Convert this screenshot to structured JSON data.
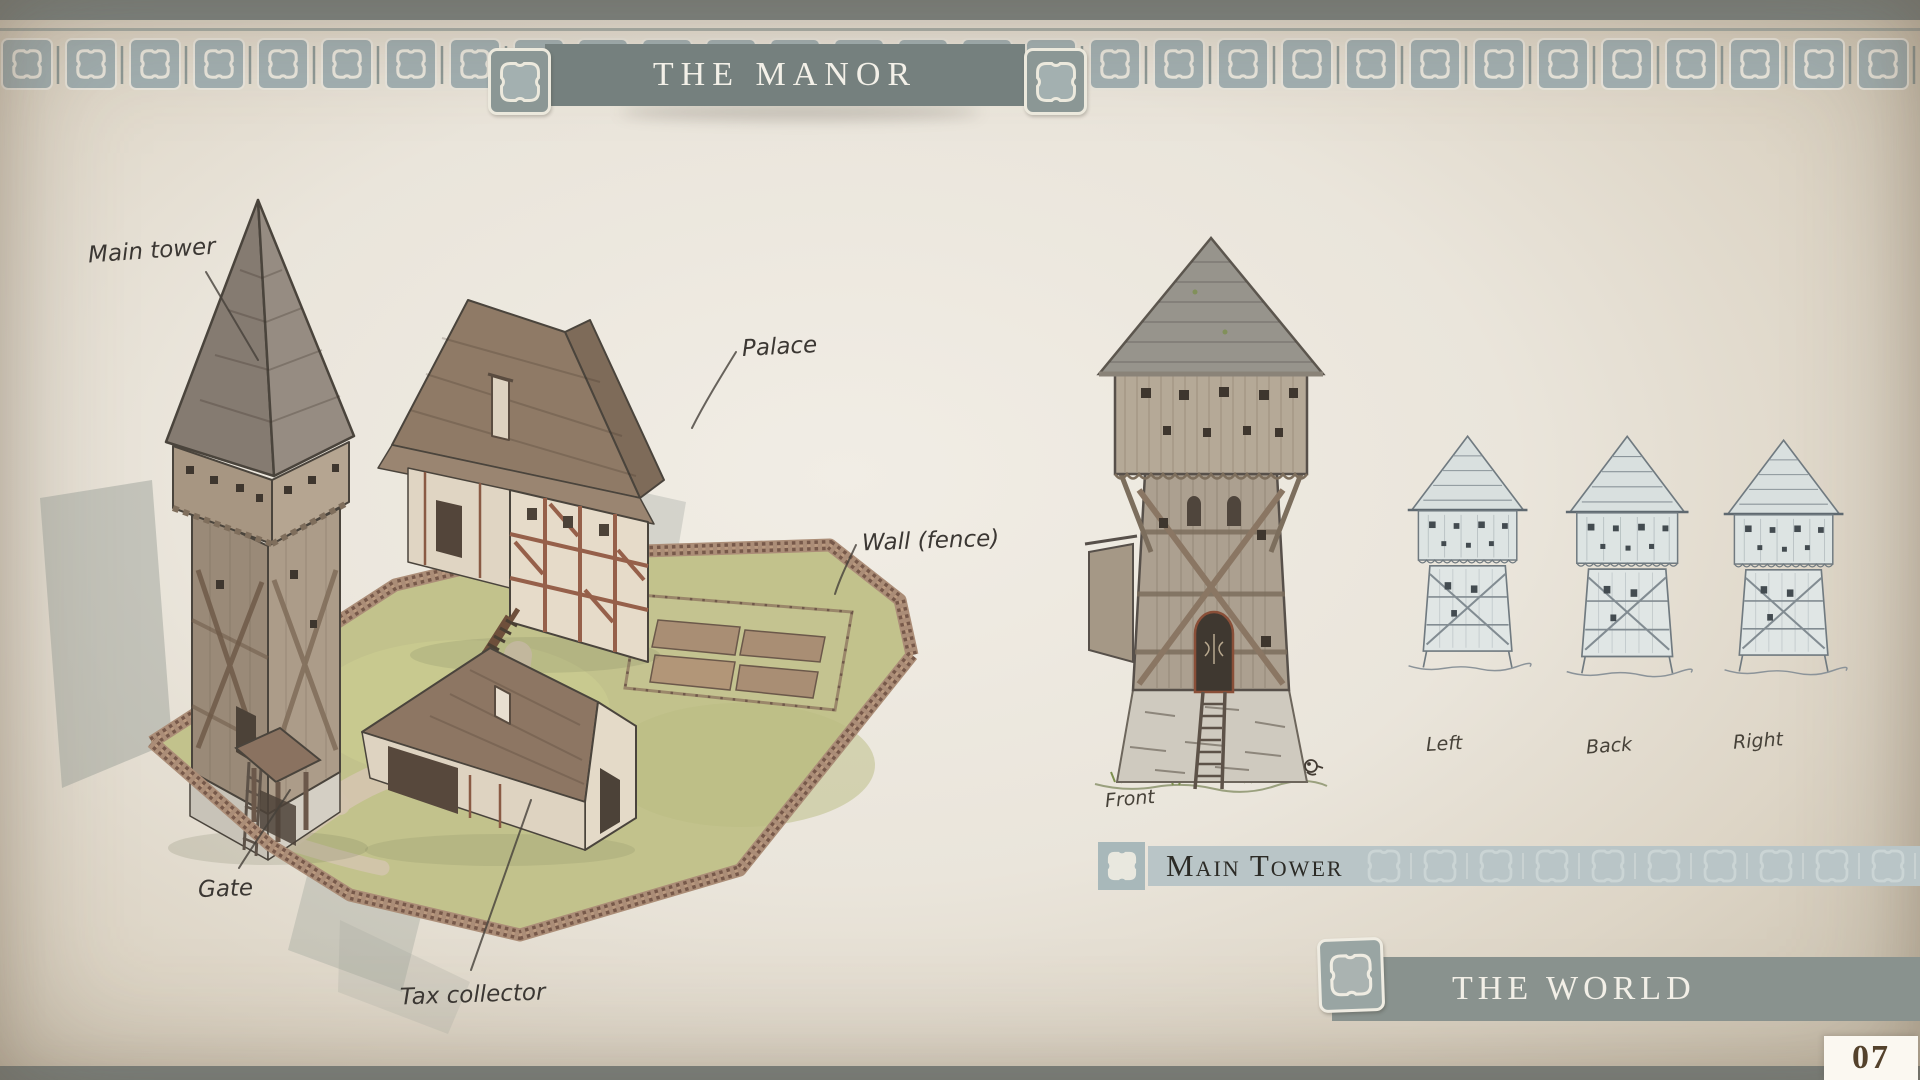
{
  "page": {
    "title": "THE MANOR",
    "number": "07"
  },
  "banners": {
    "main_tower": "Main Tower",
    "the_world": "THE WORLD"
  },
  "manor_labels": {
    "main_tower": "Main tower",
    "palace": "Palace",
    "wall": "Wall (fence)",
    "gate": "Gate",
    "tax_collector": "Tax collector"
  },
  "view_labels": {
    "front": "Front",
    "left": "Left",
    "back": "Back",
    "right": "Right"
  },
  "icons": {
    "ornament": "puzzle-piece-icon"
  },
  "colors": {
    "header_banner": "#75807e",
    "frame_bar": "#7e8785",
    "border_tile": "#a2b0b2",
    "section_bar": "#b9c5c7",
    "world_bar": "#89928e",
    "ink": "#3b3733",
    "page_number_ink": "#54422c",
    "grass": "#c2c28c",
    "fence": "#ab8d77"
  }
}
